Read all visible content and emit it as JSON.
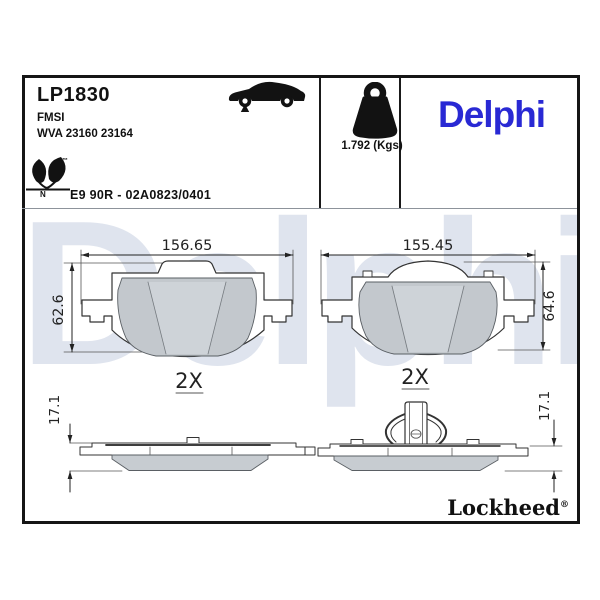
{
  "header": {
    "part_number": "LP1830",
    "fmsi_label": "FMSI",
    "wva_numbers": "WVA 23160 23164",
    "weight": "1.792 (Kgs)",
    "approval_code": "E9 90R - 02A0823/0401",
    "eco_mark_letter": "N",
    "trademark_symbol": "™",
    "brand_logo": "Delphi",
    "brand_color": "#2929d4"
  },
  "drawing": {
    "front_view_left": {
      "width_dim": "156.65",
      "height_dim": "62.6"
    },
    "front_view_right": {
      "width_dim": "155.45",
      "height_dim": "64.6"
    },
    "side_view_left": {
      "quantity": "2X",
      "thickness_dim": "17.1"
    },
    "side_view_right": {
      "quantity": "2X",
      "thickness_dim": "17.1"
    }
  },
  "footer": {
    "sub_brand": "Lockheed",
    "registered_symbol": "®"
  },
  "watermark": {
    "text": "Delphi",
    "color": "#dfe4ee"
  }
}
